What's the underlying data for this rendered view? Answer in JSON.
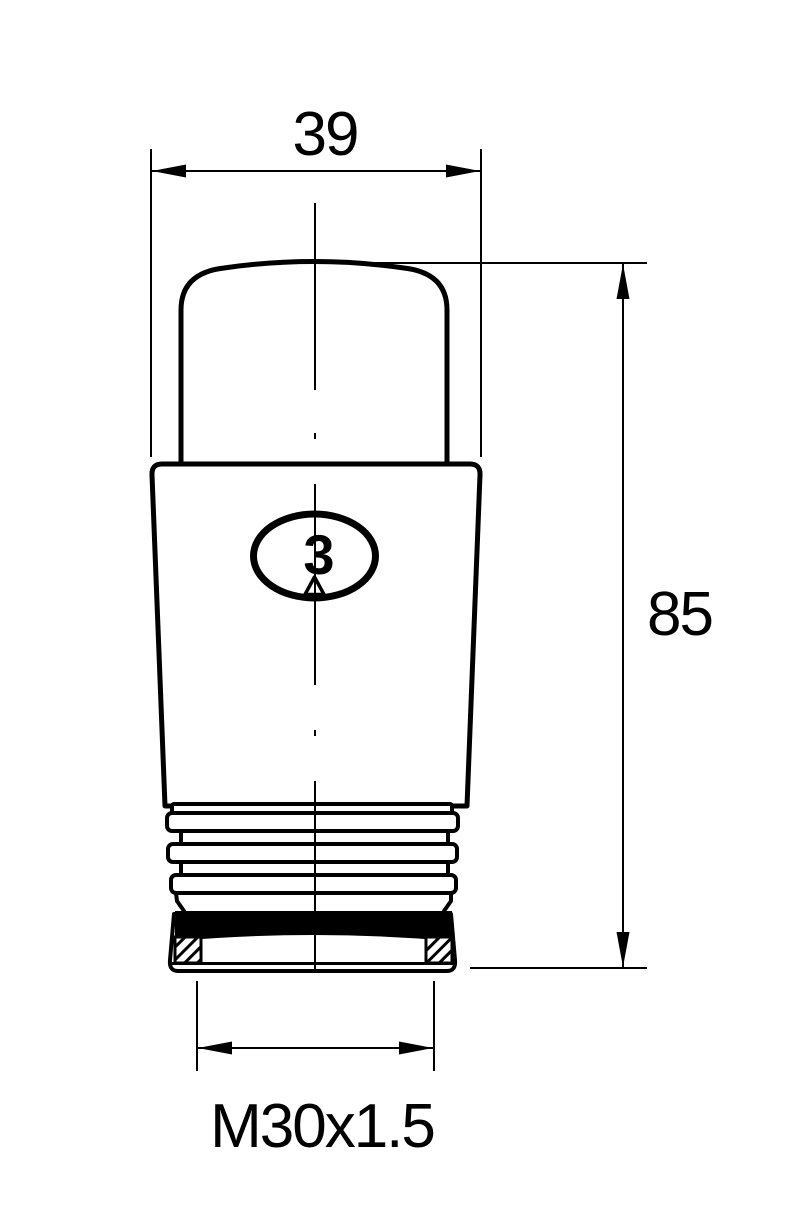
{
  "drawing": {
    "type": "technical-drawing",
    "subject": "thermostatic-radiator-valve-head",
    "labels": {
      "width_dim": "39",
      "height_dim": "85",
      "thread_dim": "M30x1.5",
      "setting_number": "3"
    },
    "colors": {
      "line": "#000000",
      "background": "#ffffff"
    }
  }
}
